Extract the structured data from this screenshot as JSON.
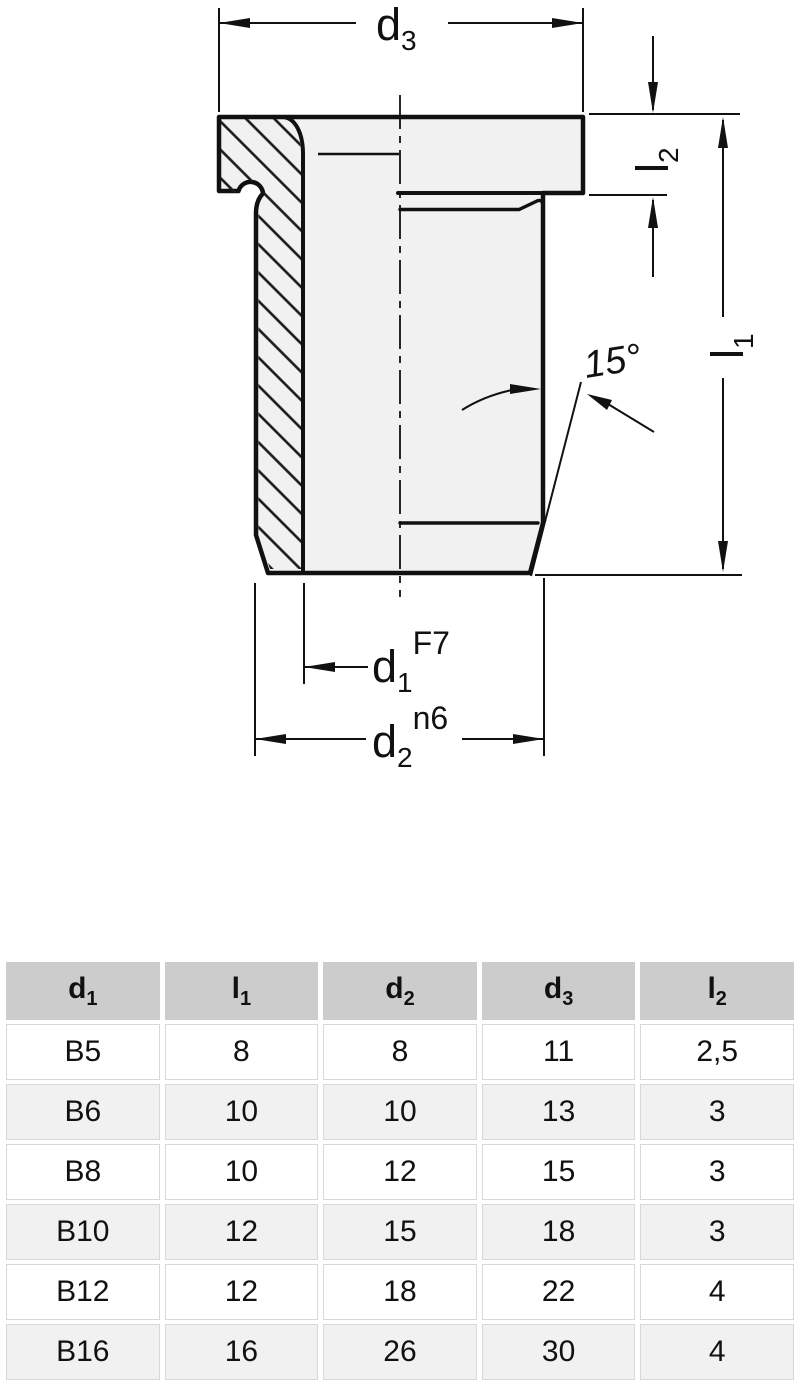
{
  "drawing": {
    "labels": {
      "d3": {
        "base": "d",
        "sub": "3"
      },
      "l2": {
        "base": "l",
        "sub": "2"
      },
      "l1": {
        "base": "l",
        "sub": "1"
      },
      "d1": {
        "base": "d",
        "sub": "1",
        "tolerance": "F7"
      },
      "d2": {
        "base": "d",
        "sub": "2",
        "tolerance": "n6"
      },
      "chamfer_angle": "15°"
    },
    "colors": {
      "line": "#111111",
      "part_fill": "#f1f1f1",
      "background": "#ffffff"
    }
  },
  "table": {
    "headers": [
      {
        "base": "d",
        "sub": "1"
      },
      {
        "base": "l",
        "sub": "1"
      },
      {
        "base": "d",
        "sub": "2"
      },
      {
        "base": "d",
        "sub": "3"
      },
      {
        "base": "l",
        "sub": "2"
      }
    ],
    "rows": [
      {
        "cells": [
          "B5",
          "8",
          "8",
          "11",
          "2,5"
        ]
      },
      {
        "cells": [
          "B6",
          "10",
          "10",
          "13",
          "3"
        ]
      },
      {
        "cells": [
          "B8",
          "10",
          "12",
          "15",
          "3"
        ]
      },
      {
        "cells": [
          "B10",
          "12",
          "15",
          "18",
          "3"
        ]
      },
      {
        "cells": [
          "B12",
          "12",
          "18",
          "22",
          "4"
        ]
      },
      {
        "cells": [
          "B16",
          "16",
          "26",
          "30",
          "4"
        ]
      }
    ],
    "colors": {
      "header_bg": "#cccccc",
      "row_bg": "#ffffff",
      "alt_row_bg": "#f1f1f1",
      "border": "#d8d8d8"
    }
  }
}
